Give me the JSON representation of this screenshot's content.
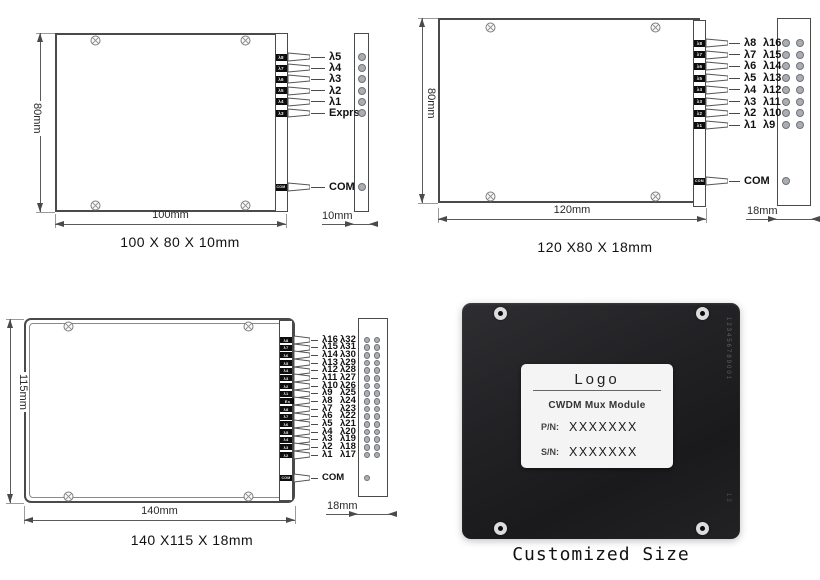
{
  "diagrams": [
    {
      "caption": "100 X 80 X 10mm",
      "height_label": "80mm",
      "width_label": "100mm",
      "depth_label": "10mm",
      "ports": [
        {
          "tag": "λ8",
          "label": "λ5"
        },
        {
          "tag": "λ7",
          "label": "λ4"
        },
        {
          "tag": "λ6",
          "label": "λ3"
        },
        {
          "tag": "λ5",
          "label": "λ2"
        },
        {
          "tag": "λ4",
          "label": "λ1"
        },
        {
          "tag": "λ3",
          "label": "Exprss"
        }
      ],
      "com": {
        "tag": "COM",
        "label": "COM"
      }
    },
    {
      "caption": "120 X80 X 18mm",
      "height_label": "80mm",
      "width_label": "120mm",
      "depth_label": "18mm",
      "ports": [
        {
          "tag": "λ8",
          "label": "λ8",
          "label2": "λ16"
        },
        {
          "tag": "λ7",
          "label": "λ7",
          "label2": "λ15"
        },
        {
          "tag": "λ6",
          "label": "λ6",
          "label2": "λ14"
        },
        {
          "tag": "λ5",
          "label": "λ5",
          "label2": "λ13"
        },
        {
          "tag": "λ4",
          "label": "λ4",
          "label2": "λ12"
        },
        {
          "tag": "λ3",
          "label": "λ3",
          "label2": "λ11"
        },
        {
          "tag": "λ2",
          "label": "λ2",
          "label2": "λ10"
        },
        {
          "tag": "λ1",
          "label": "λ1",
          "label2": "λ9"
        }
      ],
      "com": {
        "tag": "COM",
        "label": "COM"
      }
    },
    {
      "caption": "140 X115 X 18mm",
      "height_label": "115mm",
      "width_label": "140mm",
      "depth_label": "18mm",
      "ports": [
        {
          "tag": "λ8",
          "label": "λ16",
          "label2": "λ32"
        },
        {
          "tag": "λ7",
          "label": "λ15",
          "label2": "λ31"
        },
        {
          "tag": "λ6",
          "label": "λ14",
          "label2": "λ30"
        },
        {
          "tag": "λ5",
          "label": "λ13",
          "label2": "λ29"
        },
        {
          "tag": "λ4",
          "label": "λ12",
          "label2": "λ28"
        },
        {
          "tag": "λ3",
          "label": "λ11",
          "label2": "λ27"
        },
        {
          "tag": "λ2",
          "label": "λ10",
          "label2": "λ26"
        },
        {
          "tag": "λ1",
          "label": "λ9",
          "label2": "λ25"
        },
        {
          "tag": "Ex",
          "label": "λ8",
          "label2": "λ24",
          "wide": true
        },
        {
          "tag": "λ8",
          "label": "λ7",
          "label2": "λ23"
        },
        {
          "tag": "λ7",
          "label": "λ6",
          "label2": "λ22"
        },
        {
          "tag": "λ6",
          "label": "λ5",
          "label2": "λ21"
        },
        {
          "tag": "λ5",
          "label": "λ4",
          "label2": "λ20"
        },
        {
          "tag": "λ4",
          "label": "λ3",
          "label2": "λ19"
        },
        {
          "tag": "λ3",
          "label": "λ2",
          "label2": "λ18"
        },
        {
          "tag": "λ2",
          "label": "λ1",
          "label2": "λ17"
        }
      ],
      "com": {
        "tag": "COM",
        "label": "COM"
      }
    }
  ],
  "photo": {
    "logo": "Logo",
    "title": "CWDM Mux Module",
    "pn_key": "P/N:",
    "pn_value": "XXXXXXX",
    "sn_key": "S/N:",
    "sn_value": "XXXXXXX",
    "caption": "Customized Size",
    "edge_marks": "123456789001",
    "edge_marks2": "12"
  },
  "colors": {
    "line": "#4a4a4a",
    "dot_fill": "#aaadb2",
    "tag_bg": "#0d0d0d",
    "photo_body": "#202022",
    "label_bg": "#f4f4f4"
  }
}
